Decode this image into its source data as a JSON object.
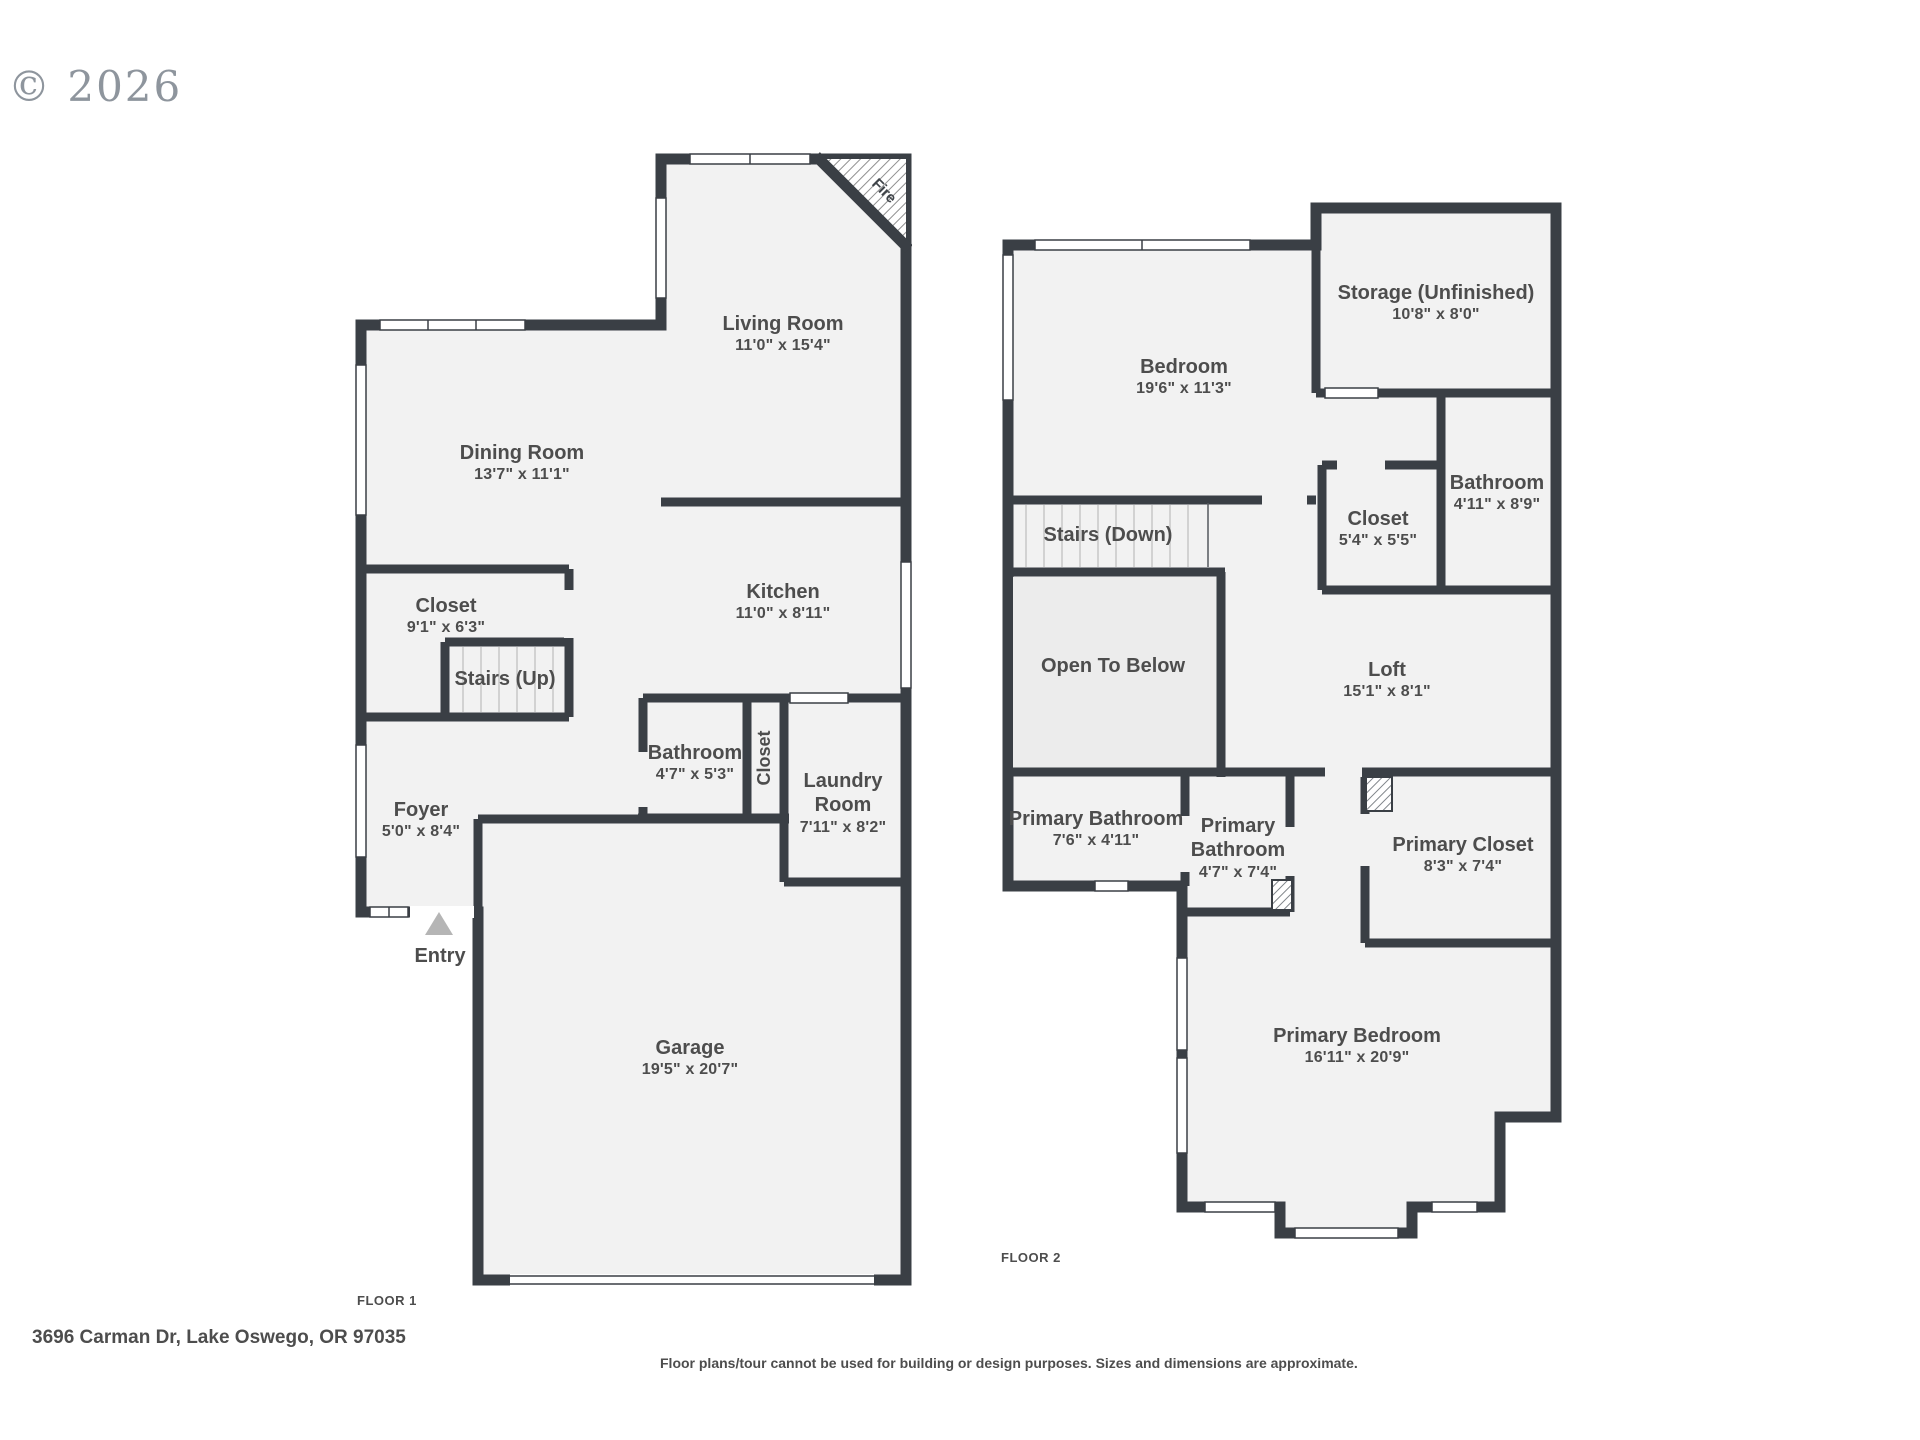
{
  "copyright": "© 2026",
  "address": "3696 Carman Dr, Lake Oswego, OR 97035",
  "disclaimer": "Floor plans/tour cannot be used for building or design purposes. Sizes and dimensions are approximate.",
  "colors": {
    "wall": "#3a3f45",
    "room_fill": "#f2f2f2",
    "open_below_fill": "#ececec",
    "label_text": "#4d4d4d"
  },
  "floor1": {
    "label": "FLOOR 1",
    "rooms": {
      "living": {
        "name": "Living Room",
        "dims": "11'0\" x 15'4\""
      },
      "dining": {
        "name": "Dining Room",
        "dims": "13'7\" x 11'1\""
      },
      "kitchen": {
        "name": "Kitchen",
        "dims": "11'0\" x 8'11\""
      },
      "closet": {
        "name": "Closet",
        "dims": "9'1\" x 6'3\""
      },
      "stairs": {
        "name": "Stairs (Up)"
      },
      "bathroom": {
        "name": "Bathroom",
        "dims": "4'7\" x 5'3\""
      },
      "hall_closet": {
        "name": "Closet"
      },
      "laundry": {
        "name": "Laundry Room",
        "dims": "7'11\" x 8'2\""
      },
      "foyer": {
        "name": "Foyer",
        "dims": "5'0\" x 8'4\""
      },
      "entry": {
        "name": "Entry"
      },
      "garage": {
        "name": "Garage",
        "dims": "19'5\" x 20'7\""
      },
      "fireplace": {
        "name": "Fire"
      }
    }
  },
  "floor2": {
    "label": "FLOOR 2",
    "rooms": {
      "bedroom": {
        "name": "Bedroom",
        "dims": "19'6\" x 11'3\""
      },
      "storage": {
        "name": "Storage (Unfinished)",
        "dims": "10'8\" x 8'0\""
      },
      "stairs": {
        "name": "Stairs (Down)"
      },
      "closet": {
        "name": "Closet",
        "dims": "5'4\" x 5'5\""
      },
      "bathroom": {
        "name": "Bathroom",
        "dims": "4'11\" x 8'9\""
      },
      "open_to_below": {
        "name": "Open To Below"
      },
      "loft": {
        "name": "Loft",
        "dims": "15'1\" x 8'1\""
      },
      "primary_bathroom_1": {
        "name": "Primary Bathroom",
        "dims": "7'6\" x 4'11\""
      },
      "primary_bathroom_2": {
        "name": "Primary Bathroom",
        "dims": "4'7\" x 7'4\""
      },
      "primary_closet": {
        "name": "Primary Closet",
        "dims": "8'3\" x 7'4\""
      },
      "primary_bedroom": {
        "name": "Primary Bedroom",
        "dims": "16'11\" x 20'9\""
      }
    }
  }
}
